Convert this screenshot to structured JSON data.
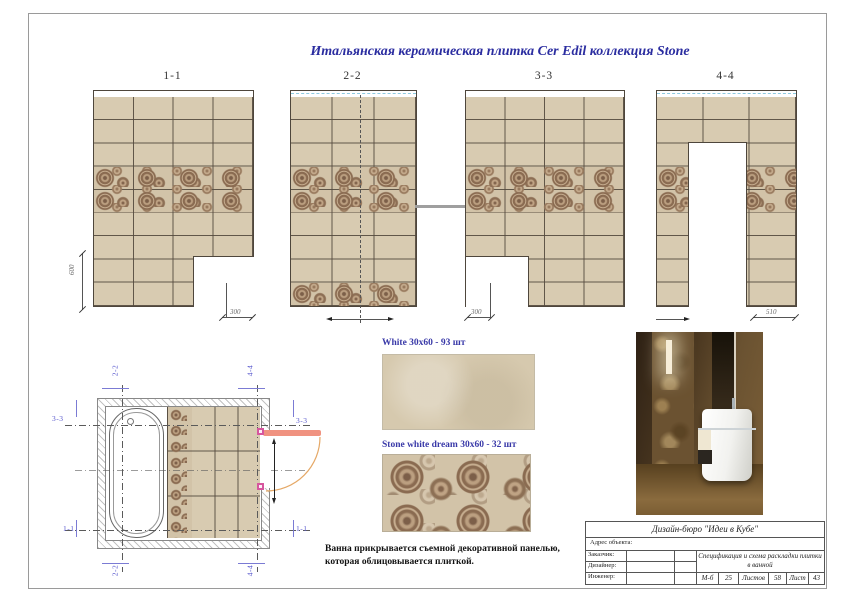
{
  "page": {
    "title": "Итальянская керамическая плитка Cer Edil коллекция Stone"
  },
  "elevations": [
    {
      "label": "1-1",
      "dim_left": "600",
      "dim_bottom": "300"
    },
    {
      "label": "2-2"
    },
    {
      "label": "3-3",
      "dim_bottom": "300"
    },
    {
      "label": "4-4",
      "dim_bottom": "510"
    }
  ],
  "samples": [
    {
      "label": "White 30x60 - 93 шт"
    },
    {
      "label": "Stone white dream 30x60 - 32 шт"
    }
  ],
  "note": {
    "line1": "Ванна прикрывается съемной декоративной панелью,",
    "line2": "которая облицовывается плиткой."
  },
  "title_block": {
    "bureau": "Дизайн-бюро \"Идеи в Кубе\"",
    "address_label": "Адрес объекта:",
    "customer_label": "Заказчик:",
    "designer_label": "Дизайнер:",
    "engineer_label": "Инженер:",
    "spec_title": "Спецификация и схема раскладки плитки в ванной",
    "scale_label": "М-б",
    "scale_value": "25",
    "sheets_label": "Листов",
    "sheets_value": "58",
    "sheet_label": "Лист",
    "sheet_value": "43"
  },
  "colors": {
    "title_blue": "#2b2da0",
    "section_label_blue": "#5a5ace",
    "tile_beige": "#d8cbb1",
    "deco_base": "#d2c3a8",
    "flower_brown": "#8a6b51",
    "grout": "#544a3e",
    "door_leaf": "#f09280",
    "door_arc": "#e5a866",
    "hinge_pink": "#d6569e",
    "ceiling_dash_blue": "#8ecbe0"
  }
}
